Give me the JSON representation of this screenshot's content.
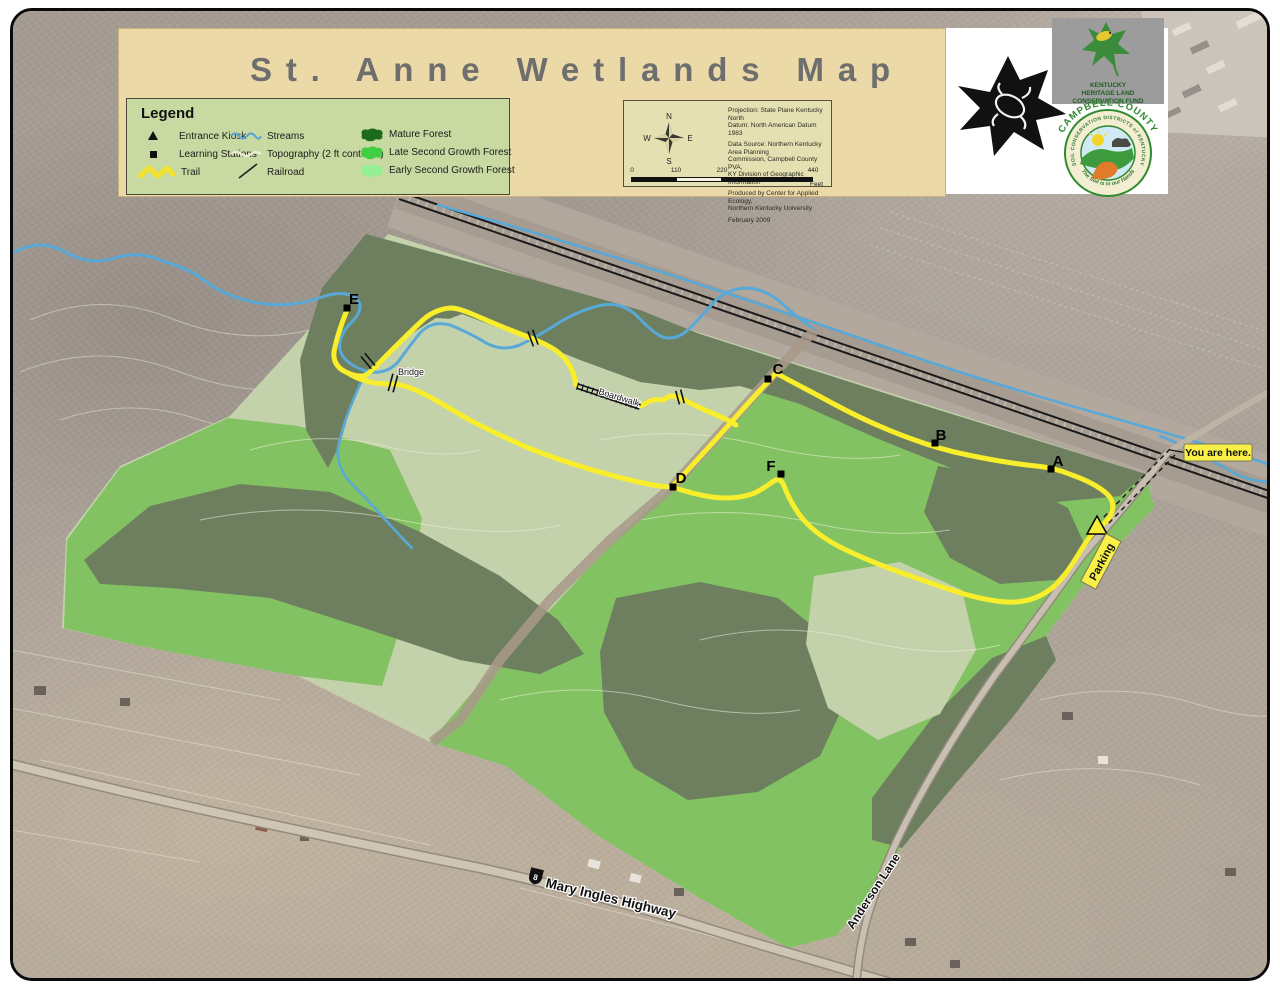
{
  "title": "St. Anne Wetlands Map",
  "legend": {
    "heading": "Legend",
    "items": [
      {
        "label": "Entrance Kiosk",
        "symbol": "kiosk-triangle"
      },
      {
        "label": "Learning Stations",
        "symbol": "station-square"
      },
      {
        "label": "Trail",
        "symbol": "trail-line",
        "color": "#f2e32e"
      },
      {
        "label": "Streams",
        "symbol": "stream-line",
        "color": "#5aa7d4"
      },
      {
        "label": "Topography (2 ft contours)",
        "symbol": "contour-line",
        "color": "#efeada"
      },
      {
        "label": "Railroad",
        "symbol": "railroad-line",
        "color": "#222222"
      },
      {
        "label": "Mature Forest",
        "symbol": "forest-patch",
        "color": "#1c6b1c"
      },
      {
        "label": "Late Second Growth Forest",
        "symbol": "forest-patch",
        "color": "#41cf41"
      },
      {
        "label": "Early Second Growth Forest",
        "symbol": "forest-patch",
        "color": "#92ef92"
      }
    ]
  },
  "info_box": {
    "projection": "Projection: State Plane Kentucky North",
    "datum": "Datum: North American Datum 1983",
    "source1": "Data Source: Northern Kentucky Area Planning",
    "source2": "Commission, Campbell County PVA,",
    "source3": "KY Division of Geographic Information",
    "produced1": "Produced by Center for Applied Ecology,",
    "produced2": "Northern Kentucky University",
    "date": "February 2009",
    "compass": {
      "n": "N",
      "s": "S",
      "e": "E",
      "w": "W"
    },
    "scale": {
      "ticks": [
        "0",
        "110",
        "220",
        "440"
      ],
      "unit": "Feet"
    }
  },
  "logos": {
    "nku": {
      "name": "NKU",
      "caption1": "Research & Education",
      "caption2": "Field Station"
    },
    "khlcf": {
      "line1": "KENTUCKY",
      "line2": "HERITAGE LAND",
      "line3": "CONSERVATION FUND"
    },
    "campbell": {
      "arc": "CAMPBELL COUNTY",
      "ring": "SOIL CONSERVATION DISTRICTS of KENTUCKY",
      "motto": "The Soil is in our Hands"
    }
  },
  "map_labels": {
    "stations": [
      "A",
      "B",
      "C",
      "D",
      "E",
      "F"
    ],
    "bridge": "Bridge",
    "boardwalk": "Boardwalk",
    "you_are_here": "You are here.",
    "parking": "Parking",
    "highway": "Mary Ingles Highway",
    "route_shield": "8",
    "lane": "Anderson Lane"
  },
  "colors": {
    "trail": "#f8ee2b",
    "stream": "#58a8d8",
    "mature_forest": "#1c6b1c",
    "late_second_growth": "#41cf41",
    "early_second_growth": "#92ef92",
    "banner": "#ecd9a8",
    "legend_bg": "#c8d9a2",
    "info_bg": "#e4e0b2",
    "label_bg": "#f8f046"
  }
}
